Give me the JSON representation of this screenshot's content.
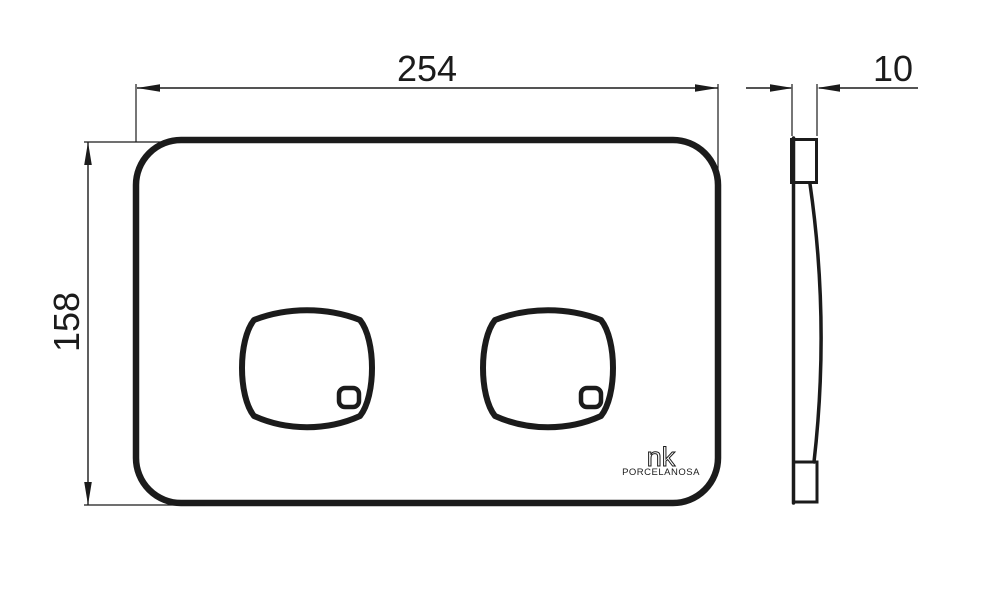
{
  "drawing": {
    "front_view": {
      "width_label": "254",
      "height_label": "158"
    },
    "side_view": {
      "thickness_label": "10"
    },
    "logo": {
      "brand": "nk",
      "company": "PORCELANOSA"
    }
  },
  "colors": {
    "line": "#1b1b1b",
    "background": "#ffffff"
  }
}
